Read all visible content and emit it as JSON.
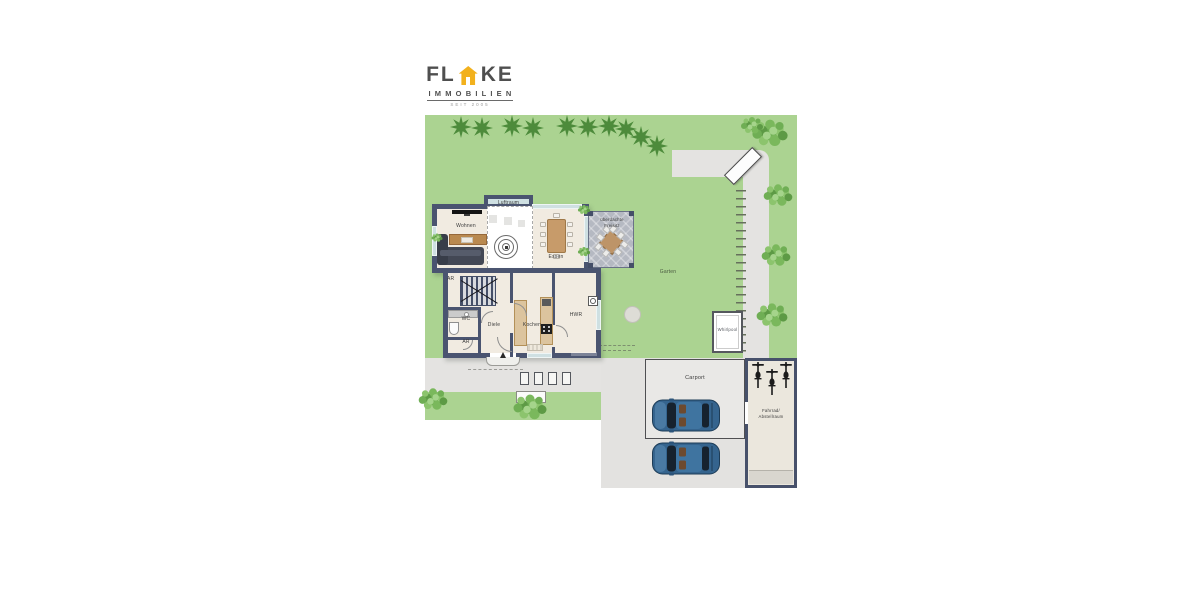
{
  "logo": {
    "brand_left": "FL",
    "brand_right": "KE",
    "subtitle": "IMMOBILIEN",
    "tagline": "SEIT 2005"
  },
  "rooms": {
    "wohnen": "Wohnen",
    "luftraum": "Luftraum",
    "essen": "Essen",
    "freisitz_line1": "überdachte",
    "freisitz_line2": "Freisitz",
    "ar_top": "AR",
    "wc": "WC",
    "ar_bottom": "AR",
    "diele": "Diele",
    "kochen": "Kochen",
    "hwr": "HWR"
  },
  "outdoor": {
    "garten": "Garten",
    "whirlpool": "Whirlpool",
    "carport": "Carport",
    "bike_room_line1": "Fahrrad/",
    "bike_room_line2": "Abstellraum"
  },
  "colors": {
    "brand_yellow": "#F2B11D",
    "brand_gray": "#4F4F4F",
    "wall": "#4A5470",
    "floor": "#F1EBE1",
    "garden_green": "#ABD391",
    "path_gray": "#E4E3E1",
    "tree_green": "#4D8B3B",
    "car_blue": "#35648E",
    "terrace_gray": "#B5B9C2"
  }
}
